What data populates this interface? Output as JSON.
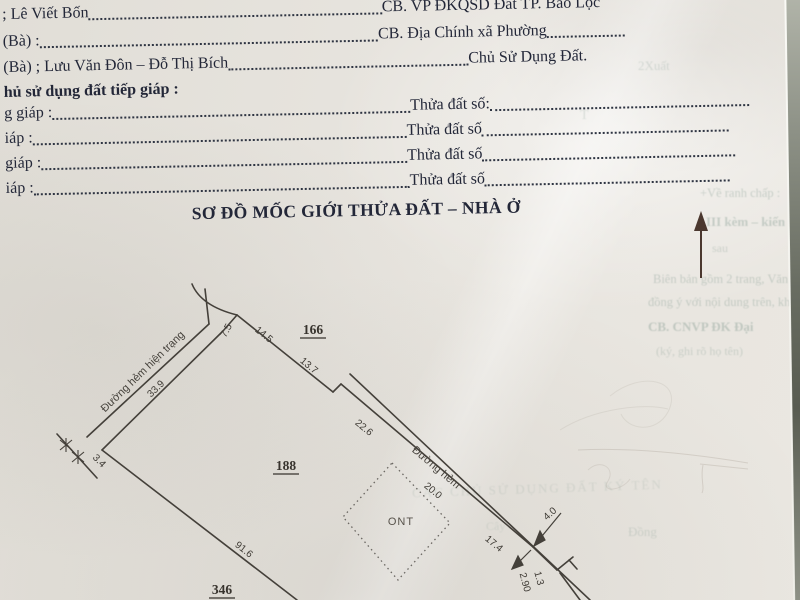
{
  "doc": {
    "line1_left": "; Lê Viết Bốn",
    "line1_right": "CB. VP ĐKQSD Đất TP. Bảo Lộc",
    "line2_left": "(Bà) :",
    "line2_right": "CB. Địa Chính xã Phường",
    "line3_left": "(Bà) ; Lưu Văn Đôn – Đỗ Thị Bích",
    "line3_right": "Chủ Sử Dụng Đất.",
    "section": "hủ sử dụng đất tiếp giáp :",
    "adj": [
      {
        "l": "g giáp :",
        "r": "Thửa đất số:"
      },
      {
        "l": "iáp :",
        "r": "Thửa đất số"
      },
      {
        "l": "giáp :",
        "r": "Thửa đất số"
      },
      {
        "l": "iáp :",
        "r": "Thửa đất số"
      }
    ],
    "heading": "SƠ ĐỒ MỐC GIỚI THỬA ĐẤT – NHÀ Ở"
  },
  "diagram": {
    "parcels": {
      "p166": "166",
      "p188": "188",
      "p346": "346"
    },
    "land_use": "ONT",
    "road1": "Đường hẻm hiện trạng",
    "road2": "Đường hẻm",
    "dims": {
      "d7_5": "7.5",
      "d14_5": "14.5",
      "d13_7": "13.7",
      "d33_9": "33.9",
      "d3_4": "3.4",
      "d91_6": "91.6",
      "d22_6": "22.6",
      "d20_0": "20.0",
      "d17_4": "17.4",
      "d4_0": "4.0",
      "d1_3": "1.3",
      "d2_90": "2.90"
    }
  },
  "bleed": {
    "t1": "2Xuất",
    "t2": "T",
    "t3": "+Về ranh chấp :",
    "t4": "III kèm – kiến nghị",
    "t5": "sau",
    "t6": "Biên bản gồm 2 trang, Văn",
    "t7": "đồng ý với nội dung trên, không",
    "t8": "CB. CNVP ĐK  Đại",
    "t9": "(ký, ghi rõ họ tên)",
    "t10": "CÁC CHỦ SỬ DỤNG ĐẤT KÝ TÊN",
    "t11": "Cây",
    "t12": "Đồng"
  }
}
